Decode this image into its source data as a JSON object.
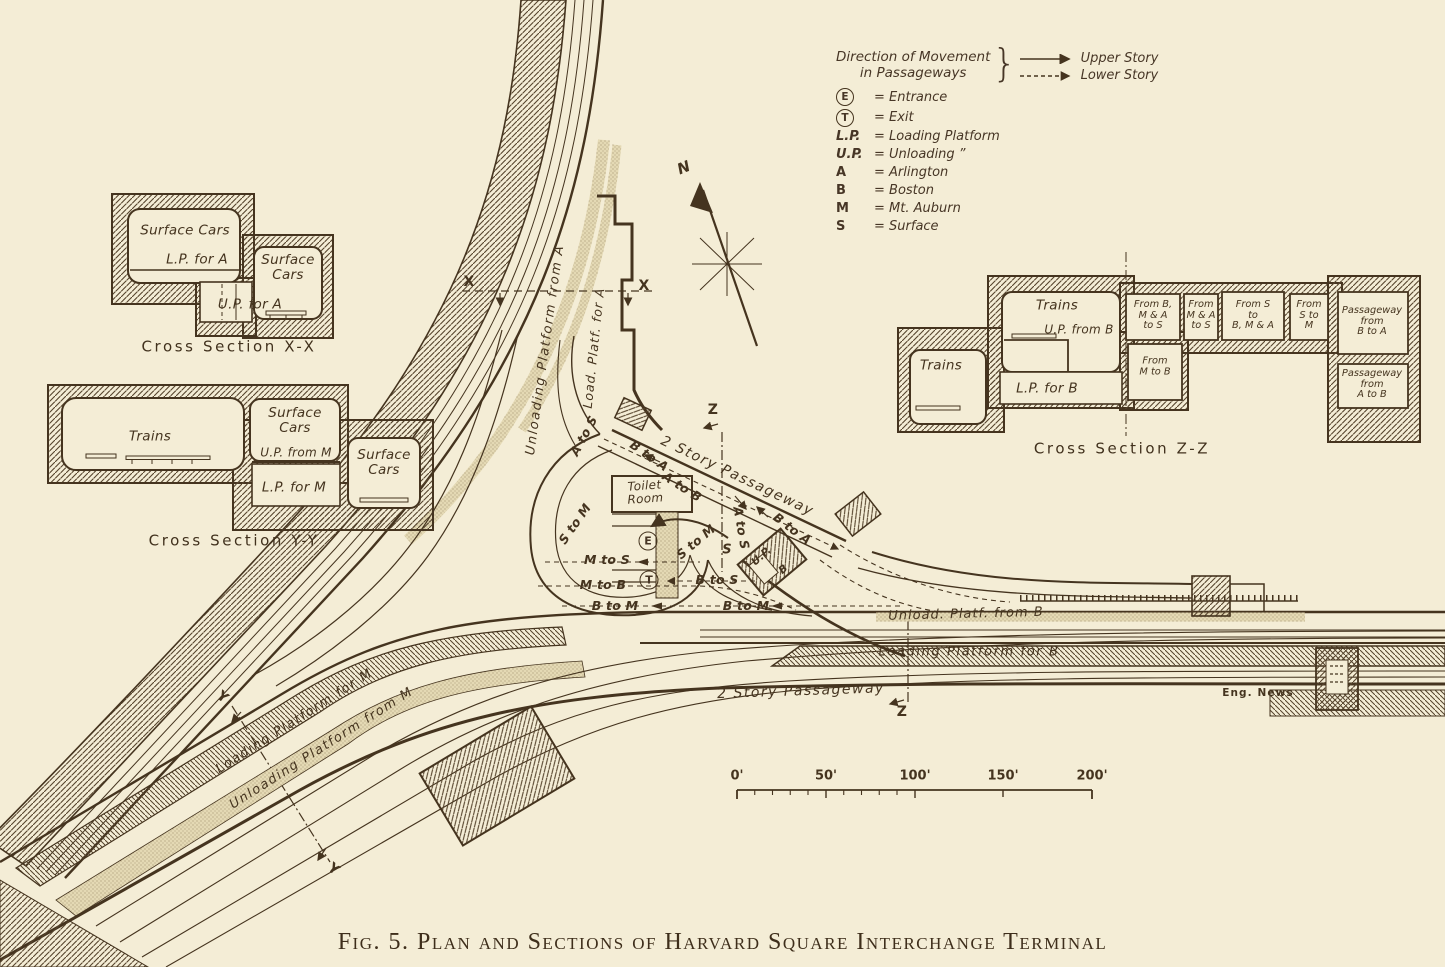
{
  "figure": {
    "caption": "Fig. 5. Plan and Sections of Harvard Square Interchange Terminal",
    "credit": "Eng. News"
  },
  "legend": {
    "title": "Direction of Movement\nin Passageways",
    "upper_story": "Upper Story",
    "lower_story": "Lower Story",
    "entries": [
      {
        "symbol": "E",
        "text": "= Entrance"
      },
      {
        "symbol": "T",
        "text": "= Exit"
      },
      {
        "symbol": "L.P.",
        "text": "= Loading Platform"
      },
      {
        "symbol": "U.P.",
        "text": "= Unloading ”"
      },
      {
        "symbol": "A",
        "text": "= Arlington"
      },
      {
        "symbol": "B",
        "text": "= Boston"
      },
      {
        "symbol": "M",
        "text": "= Mt. Auburn"
      },
      {
        "symbol": "S",
        "text": "= Surface"
      }
    ]
  },
  "sections": {
    "xx": {
      "caption": "Cross Section X-X",
      "room1": "Surface Cars",
      "room1_platform": "L.P. for A",
      "room2": "Surface\nCars",
      "room2_platform": "U.P. for A"
    },
    "yy": {
      "caption": "Cross Section Y-Y",
      "room1": "Trains",
      "room2": "Surface\nCars",
      "room2_platform": "U.P. from M",
      "room3": "L.P. for M",
      "room4": "Surface\nCars"
    },
    "zz": {
      "caption": "Cross Section Z-Z",
      "room1": "Trains",
      "room2": "Trains",
      "room2_platform": "U.P. from B",
      "room3": "L.P. for B",
      "box1": "From B,\nM & A\nto S",
      "box2": "From\nM & A\nto S",
      "box3": "From S\nto\nB, M & A",
      "box4": "From\nS to\nM",
      "box5": "Passageway\nfrom\nB to A",
      "box6": "From\nM to B",
      "box7": "Passageway\nfrom\nA to B"
    }
  },
  "plan": {
    "unloading_platform_a": "Unloading Platform from A",
    "load_platf_a": "Load. Platf. for A",
    "passageway_upper": "2 Story Passageway",
    "passageway_lower": "2 Story Passageway",
    "toilet_room": "Toilet\nRoom",
    "entrance": "E",
    "exit": "T",
    "b_to_a_1": "B to A",
    "a_to_b": "A to B",
    "b_to_a_2": "B to A",
    "a_to_s_1": "A to S",
    "a_to_s_2": "A to S",
    "s_to_m_1": "S to M",
    "s_to_m_2": "S to M",
    "m_to_s": "M to S",
    "m_to_b": "M to B",
    "b_to_s": "B to S",
    "b_to_m_1": "B to M",
    "b_to_m_2": "B to M",
    "s_label": "S",
    "up_label": "U.P.",
    "b_label": "B",
    "unload_platf_b": "Unload. Platf. from B",
    "loading_platform_b": "Loading Platform for B",
    "loading_platform_m": "Loading Platform for M",
    "unloading_platform_m": "Unloading Platform from M",
    "marker_x": "X",
    "marker_y": "Y",
    "marker_z": "Z",
    "north": "N"
  },
  "scale_bar": {
    "ticks": [
      "0'",
      "50'",
      "100'",
      "150'",
      "200'"
    ]
  }
}
